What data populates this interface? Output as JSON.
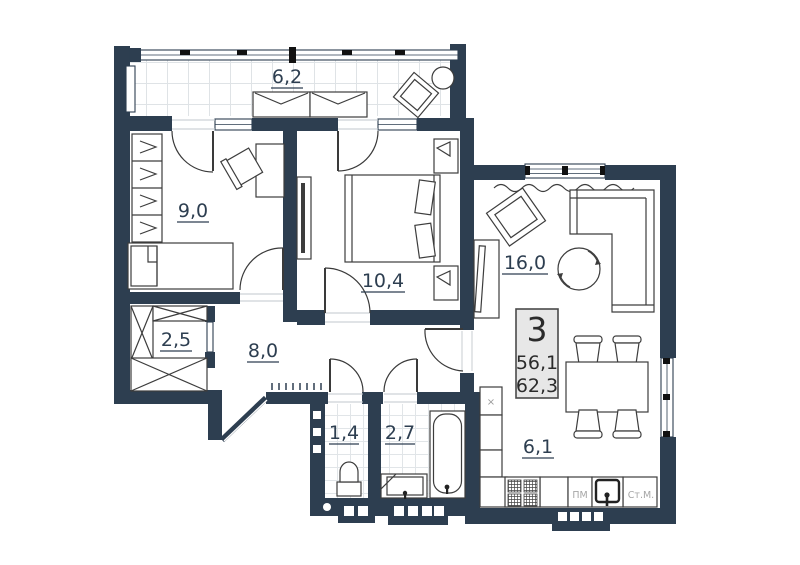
{
  "plan": {
    "apartment": {
      "number": "3",
      "living_area": "56,1",
      "total_area": "62,3"
    },
    "rooms": {
      "balcony": {
        "label": "6,2"
      },
      "bedroom_1": {
        "label": "9,0"
      },
      "bedroom_2": {
        "label": "10,4"
      },
      "living_room": {
        "label": "16,0"
      },
      "wardrobe": {
        "label": "2,5"
      },
      "hallway": {
        "label": "8,0"
      },
      "wc": {
        "label": "1,4"
      },
      "bathroom": {
        "label": "2,7"
      },
      "kitchen": {
        "label": "6,1"
      }
    },
    "appliances": {
      "dishwasher": "ПМ",
      "washer": "Ст.М.",
      "sink_mark": "×"
    },
    "colors": {
      "wall": "#2d3e50",
      "label": "#2d3e50",
      "tile_line": "#dfe3e6",
      "furniture_line": "#3d3d3d",
      "info_box_bg": "#e7e7e7",
      "info_text": "#2b2b2b"
    }
  }
}
